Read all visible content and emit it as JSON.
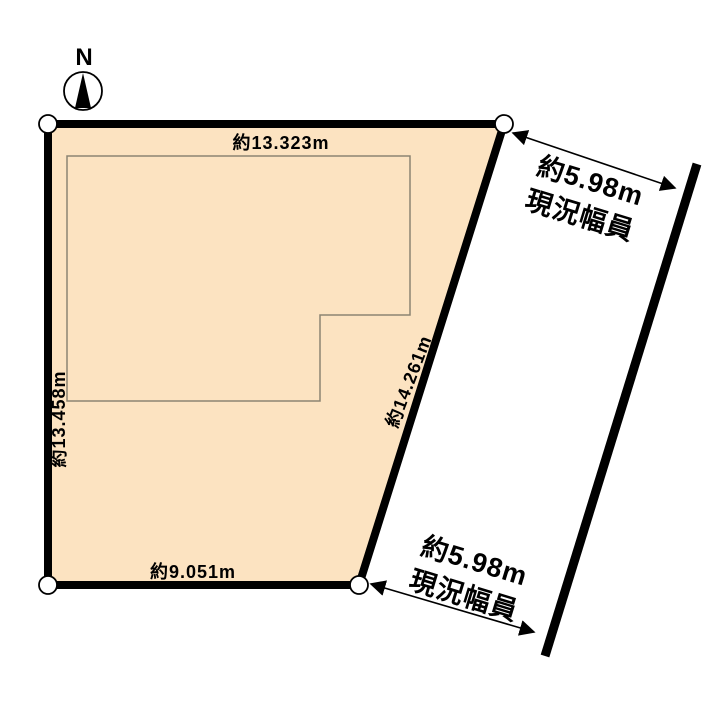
{
  "page": {
    "background": "#ffffff"
  },
  "compass": {
    "label": "N"
  },
  "parcel": {
    "fill": "#fce3c1",
    "outline_color": "#000000",
    "dimensions": {
      "top": "約13.323m",
      "left": "約13.458m",
      "right": "約14.261m",
      "bottom": "約9.051m"
    }
  },
  "building": {
    "outline_color": "#8b8472"
  },
  "road": {
    "line_color": "#000000",
    "top_label": {
      "width": "約5.98m",
      "caption": "現況幅員"
    },
    "bottom_label": {
      "width": "約5.98m",
      "caption": "現況幅員"
    }
  }
}
